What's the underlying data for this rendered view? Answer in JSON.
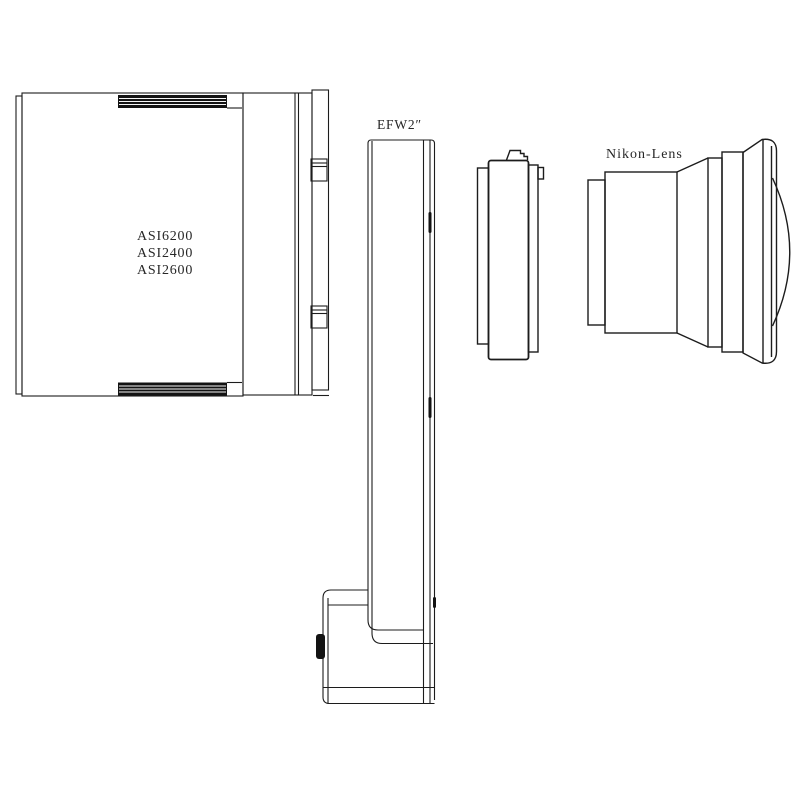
{
  "diagram": {
    "camera": {
      "models": [
        "ASI6200",
        "ASI2400",
        "ASI2600"
      ]
    },
    "filter_wheel": {
      "label": "EFW2″"
    },
    "lens": {
      "label": "Nikon-Lens"
    },
    "colors": {
      "line": "#1c1c1c",
      "background": "#ffffff",
      "heatsink_fill": "#131313"
    }
  }
}
